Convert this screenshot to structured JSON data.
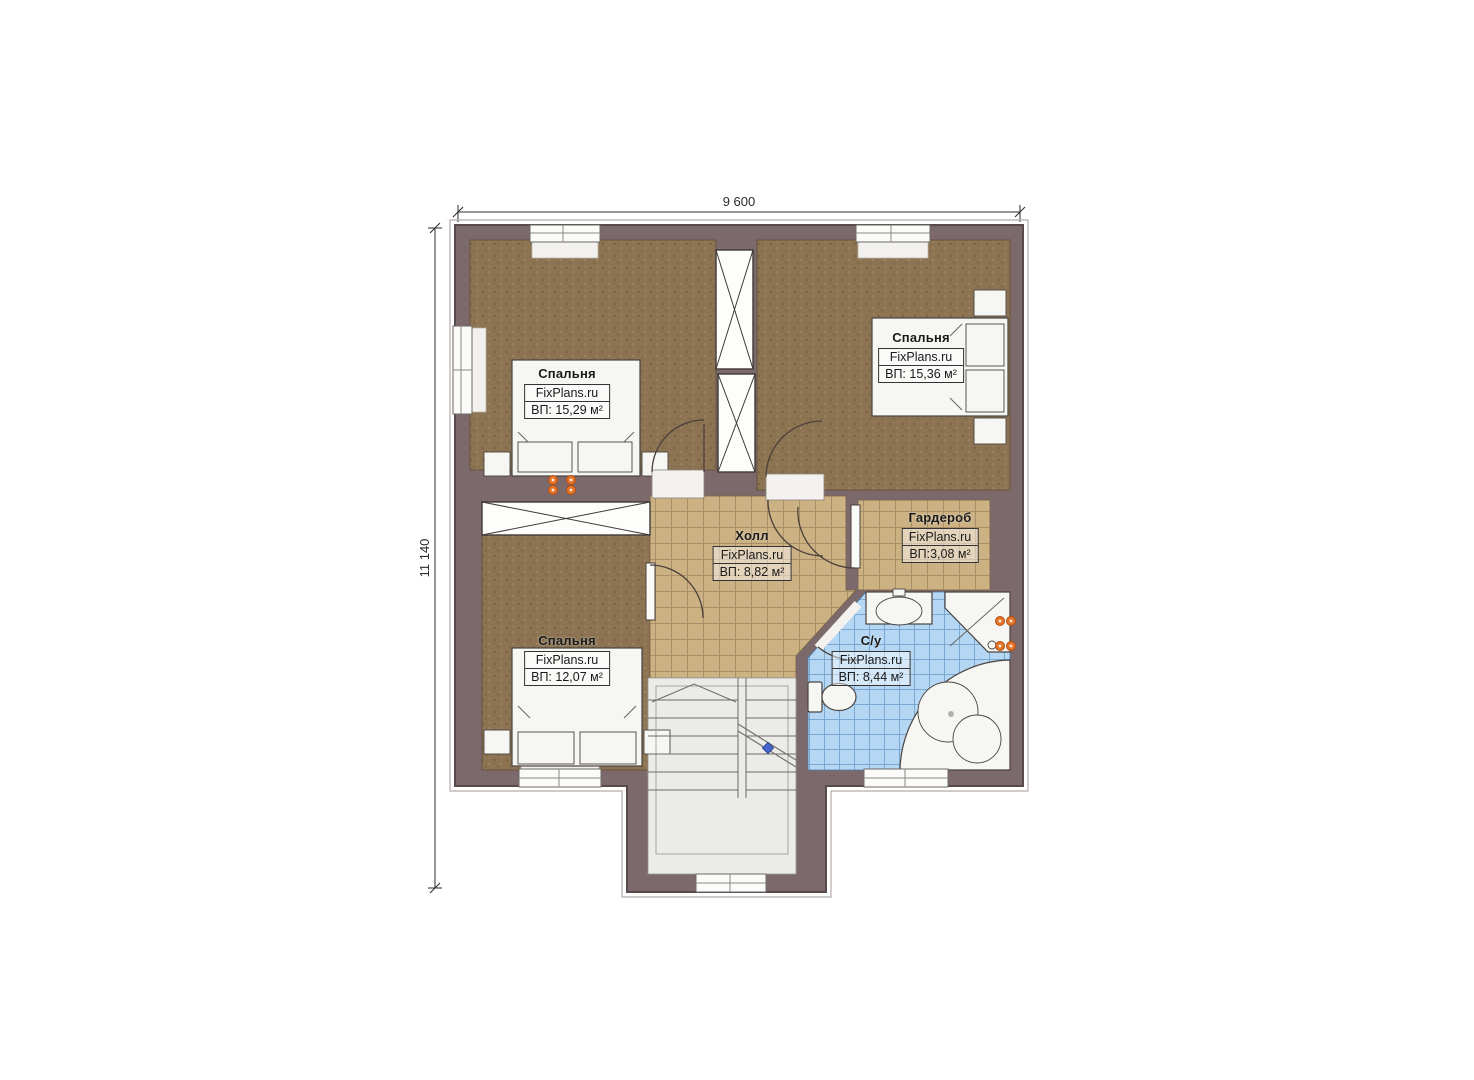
{
  "dimensions": {
    "width_label": "9 600",
    "height_label": "11 140"
  },
  "rooms": [
    {
      "id": "bedroom-top-left",
      "name": "Спальня",
      "brand": "FixPlans.ru",
      "area": "ВП: 15,29 м²"
    },
    {
      "id": "bedroom-top-right",
      "name": "Спальня",
      "brand": "FixPlans.ru",
      "area": "ВП: 15,36 м²"
    },
    {
      "id": "hall",
      "name": "Холл",
      "brand": "FixPlans.ru",
      "area": "ВП: 8,82 м²"
    },
    {
      "id": "wardrobe",
      "name": "Гардероб",
      "brand": "FixPlans.ru",
      "area": "ВП:3,08 м²"
    },
    {
      "id": "bathroom",
      "name": "С/у",
      "brand": "FixPlans.ru",
      "area": "ВП: 8,44 м²"
    },
    {
      "id": "bedroom-bottom-left",
      "name": "Спальня",
      "brand": "FixPlans.ru",
      "area": "ВП: 12,07 м²"
    }
  ],
  "colors": {
    "wall": "#7c696b",
    "bedroomFloor": "#8c7452",
    "hallTile": "#ccb183",
    "bathTile": "#b5d7f3",
    "socket": "#e4742a",
    "breakMarker": "#4466cc"
  }
}
